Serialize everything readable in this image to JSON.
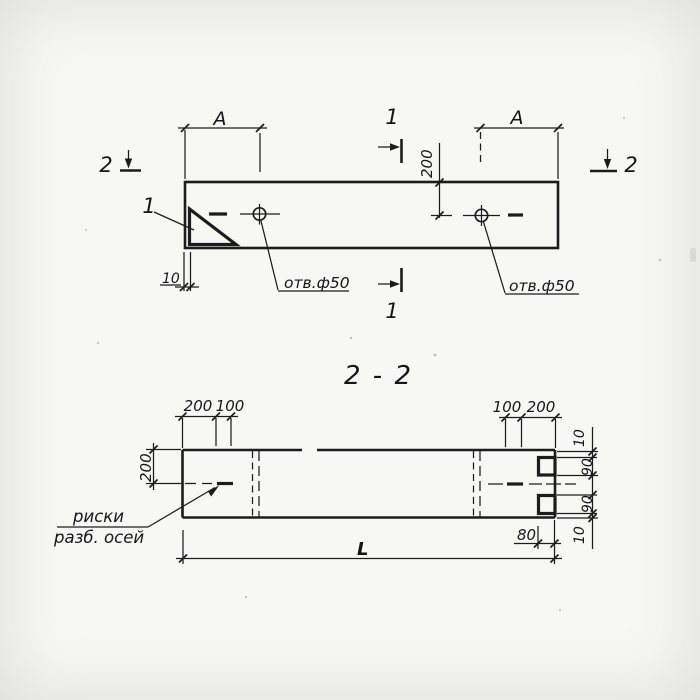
{
  "colors": {
    "ink": "#1c1c1c",
    "paper": "#f7f7f4"
  },
  "plan": {
    "dim_a_left": "А",
    "dim_a_right": "А",
    "dim_200": "200",
    "dim_10": "10",
    "hole_left": "отв.ф50",
    "hole_right": "отв.ф50",
    "section1_top": "1",
    "section1_bottom": "1",
    "section2_left": "2",
    "section2_right": "2",
    "detail": "1"
  },
  "section": {
    "title": "2 - 2",
    "top_left": [
      "200",
      "100"
    ],
    "top_right": [
      "100",
      "200"
    ],
    "left_height": "200",
    "right_chain": [
      "10",
      "90",
      "90",
      "10"
    ],
    "bottom_end": "80",
    "length": "L",
    "axis_note_line1": "риски",
    "axis_note_line2": "разб. осей"
  }
}
